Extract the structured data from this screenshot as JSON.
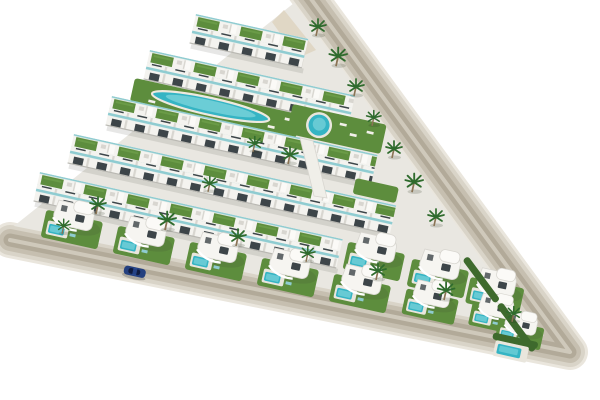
{
  "scene": {
    "title": "Aerial 3D render of a triangular beachfront-style residential development with white modern homes, green roofs, pools and palm trees",
    "type": "architectural-render",
    "view": "aerial-oblique",
    "site_shape": "triangle",
    "background": "white studio backdrop"
  },
  "colors": {
    "background": "#ffffff",
    "ground": "#e9e7e1",
    "road_shoulder": "#eae6dd",
    "road_edge": "#d9d4c8",
    "road": "#c6bfb0",
    "road_lane": "#b2aa99",
    "road_stripe": "#cfc9bb",
    "building": "#f4f3ef",
    "building_shade": "#d8d6d0",
    "window": "#3d4549",
    "glass": "#8fccd1",
    "grass": "#5d8d3d",
    "hedge": "#3e6a2d",
    "pool": "#35b4c4",
    "pool_light": "#8fdde2",
    "palm": "#2f6b2d",
    "trunk": "#8a7354",
    "sand": "#ded4c0",
    "deck": "#e9e6dd",
    "car": "#24407f",
    "shadow": "rgba(60,60,50,0.12)"
  },
  "objects": {
    "apartment_rows": 5,
    "detached_villas": 11,
    "lagoon_pools": 1,
    "round_pools": 1,
    "villa_pools": 11,
    "corner_pools": 1,
    "palm_trees": 18,
    "vehicles": 1,
    "perimeter_roads": 2
  }
}
